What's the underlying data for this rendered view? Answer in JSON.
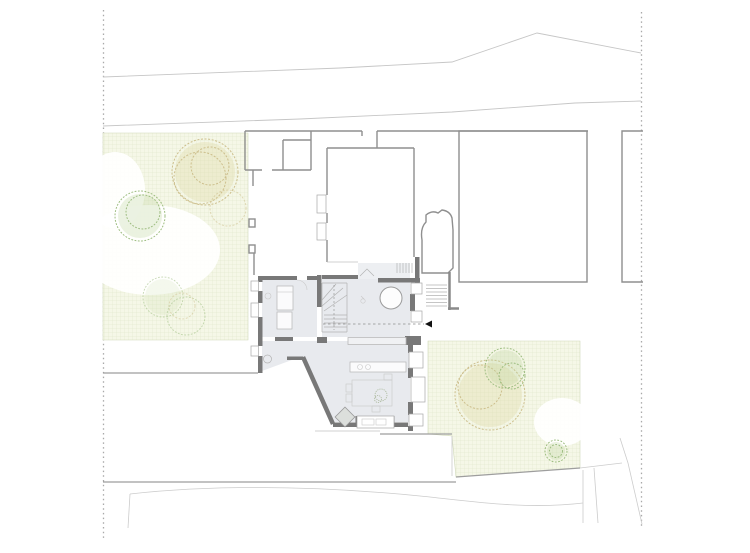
{
  "canvas": {
    "width": 750,
    "height": 553
  },
  "document_type": "architectural site plan drawing (ground floor)",
  "labels": {
    "drawing": "site plan with ground-floor plan of central house, neighbouring buildings, two gardens and street lines",
    "left_garden": "left garden with grid hatch, two large trees and shrubs",
    "right_garden": "right garden with grid hatch, large tree and small tree",
    "main_plan": "detailed ground floor plan with stair, round table, kitchen and furniture",
    "section_arrow": "black section/view arrow pointing left at end of dashed reference line",
    "plot_boundary_left": "dotted plot boundary line, left",
    "plot_boundary_right": "dotted plot boundary line, right"
  },
  "colors": {
    "paper": "#ffffff",
    "floor_fill": "#e8eaee",
    "wall": "#787878",
    "neighbor_wall": "#8f8f8f",
    "boundary": "#c6c6c6",
    "road": "#9e9e9e",
    "dotted": "#a9a9a9",
    "garden_bg": "#f5f7e7",
    "garden_grid": "#dde6c7",
    "tree_tan": "#cdbf8d",
    "tree_green": "#9dbd80",
    "arrow": "#111111"
  },
  "icons": {
    "section_arrow": "solid triangle pointing left"
  }
}
